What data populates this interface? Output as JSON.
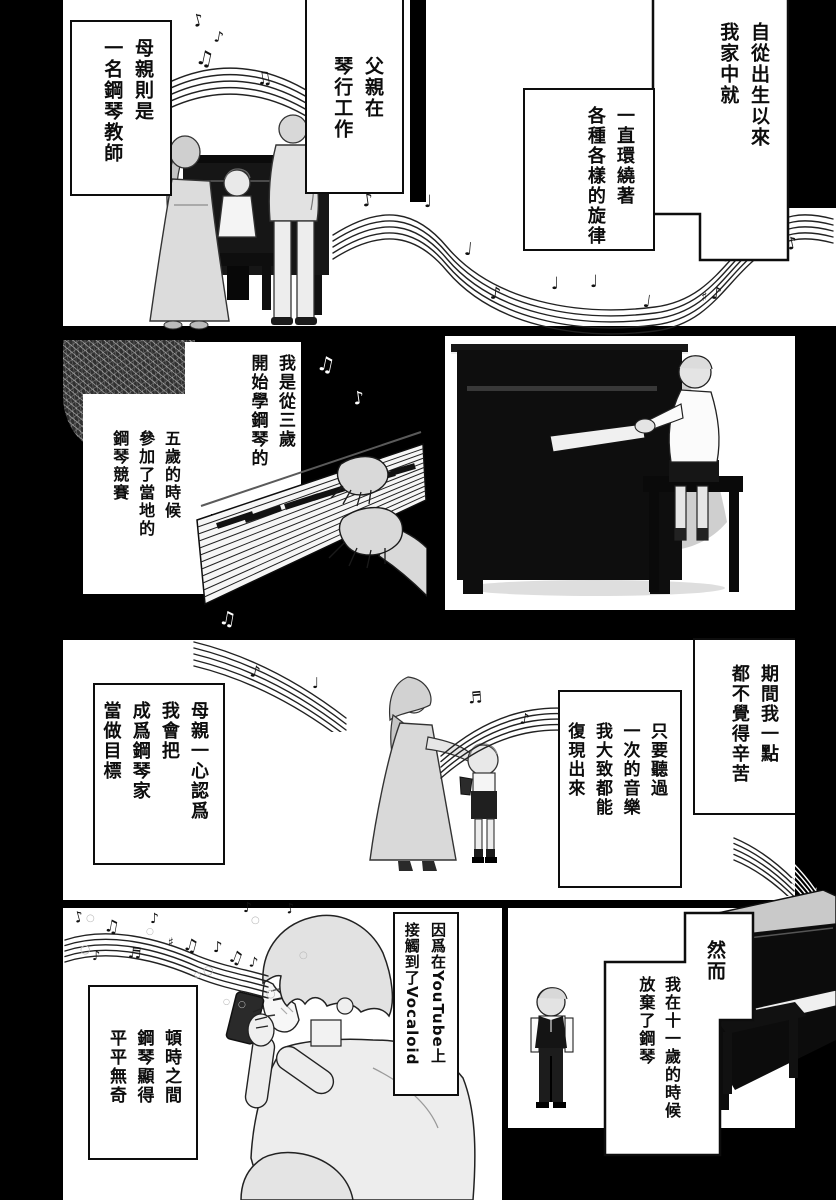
{
  "colors": {
    "page_background": "#000000",
    "panel_background": "#ffffff",
    "ink": "#111111",
    "figure_gray": "#d9d9d9"
  },
  "icons": {
    "eighth_note": "♪",
    "beamed_note": "♫",
    "beamed_sixteenth": "♬",
    "quarter_note": "♩",
    "sharp": "♯",
    "sparkle": "○"
  },
  "panel1": {
    "bubble_birth": "自從出生以來\n我家中就",
    "bubble_melody": "一直環繞著\n各種各樣的旋律",
    "bubble_mother": "母親則是\n一名鋼琴教師",
    "bubble_father": "父親在\n琴行工作"
  },
  "panel2": {
    "bubble_start": "我是從三歲\n開始學鋼琴的",
    "bubble_contest": "五歲的時候\n參加了當地的\n鋼琴競賽"
  },
  "panel3": {
    "bubble_effort": "期間我一點\n都不覺得辛苦",
    "bubble_replay": "只要聽過\n一次的音樂\n我大致都能\n復現出來",
    "bubble_goal": "母親一心認爲\n我會把\n成爲鋼琴家\n當做目標"
  },
  "panel4": {
    "bubble_however": "然而",
    "bubble_quit": "我在十一歲的時候\n放棄了鋼琴",
    "bubble_youtube": "因爲在YouTube上\n接觸到了Vocaloid",
    "bubble_plain": "頓時之間\n鋼琴顯得\n平平無奇"
  }
}
